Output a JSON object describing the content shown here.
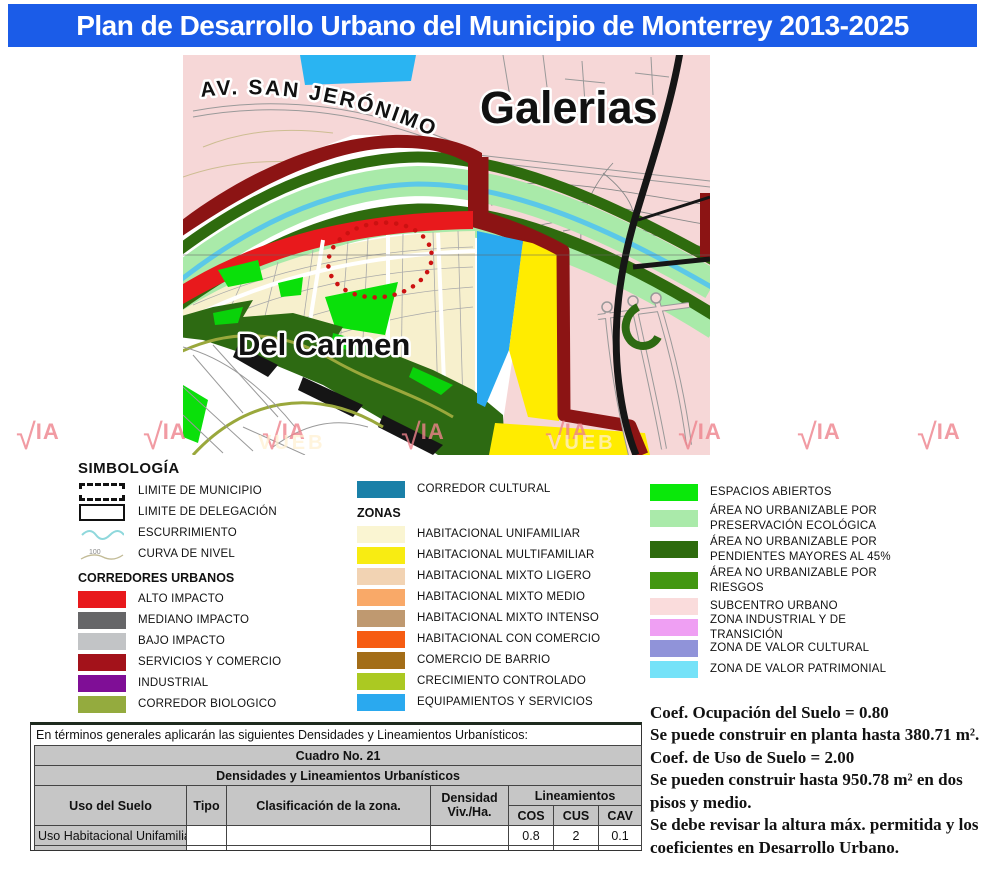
{
  "title": "Plan de Desarrollo Urbano del Municipio de Monterrey 2013-2025",
  "title_bar_color": "#1b5ce8",
  "map": {
    "labels": {
      "street": "AV. SAN JERÓNIMO",
      "district_right": "Galerias",
      "district_left": "Del Carmen"
    },
    "watermark": {
      "text": "IA",
      "fragment": "VUEB"
    }
  },
  "legend": {
    "title": "SIMBOLOGÍA",
    "symbols": [
      {
        "label": "LIMITE DE MUNICIPIO"
      },
      {
        "label": "LIMITE DE DELEGACIÓN"
      },
      {
        "label": "ESCURRIMIENTO"
      },
      {
        "label": "CURVA DE NIVEL",
        "tick": "100"
      }
    ],
    "corredores": {
      "title": "CORREDORES URBANOS",
      "items": [
        {
          "label": "ALTO IMPACTO",
          "color": "#e8191c"
        },
        {
          "label": "MEDIANO IMPACTO",
          "color": "#666668"
        },
        {
          "label": "BAJO IMPACTO",
          "color": "#c2c4c6"
        },
        {
          "label": "SERVICIOS Y COMERCIO",
          "color": "#a3121a"
        },
        {
          "label": "INDUSTRIAL",
          "color": "#7f0e96"
        },
        {
          "label": "CORREDOR BIOLOGICO",
          "color": "#94ab3e"
        }
      ]
    },
    "cultural": {
      "label": "CORREDOR CULTURAL",
      "color": "#1a80a8"
    },
    "zonas": {
      "title": "ZONAS",
      "items": [
        {
          "label": "HABITACIONAL UNIFAMILIAR",
          "color": "#faf5d2"
        },
        {
          "label": "HABITACIONAL MULTIFAMILIAR",
          "color": "#f8ec12"
        },
        {
          "label": "HABITACIONAL MIXTO LIGERO",
          "color": "#f2d3b3"
        },
        {
          "label": "HABITACIONAL MIXTO MEDIO",
          "color": "#f9a968"
        },
        {
          "label": "HABITACIONAL MIXTO INTENSO",
          "color": "#bf9970"
        },
        {
          "label": "HABITACIONAL CON COMERCIO",
          "color": "#f65c12"
        },
        {
          "label": "COMERCIO DE BARRIO",
          "color": "#a36d18"
        },
        {
          "label": "CRECIMIENTO CONTROLADO",
          "color": "#abc922"
        },
        {
          "label": "EQUIPAMIENTOS Y SERVICIOS",
          "color": "#2aa9ef"
        }
      ]
    },
    "areas": {
      "items": [
        {
          "label": "ESPACIOS ABIERTOS",
          "color": "#0ae80a"
        },
        {
          "label": "ÁREA NO URBANIZABLE POR PRESERVACIÓN ECOLÓGICA",
          "color": "#aaeaaa"
        },
        {
          "label": "ÁREA NO URBANIZABLE POR PENDIENTES MAYORES AL 45%",
          "color": "#2e6b0e"
        },
        {
          "label": "ÁREA NO URBANIZABLE POR RIESGOS",
          "color": "#429711"
        },
        {
          "label": "SUBCENTRO URBANO",
          "color": "#fadcdc"
        },
        {
          "label": "ZONA INDUSTRIAL Y DE TRANSICIÓN",
          "color": "#ef9ff3"
        },
        {
          "label": "ZONA DE VALOR CULTURAL",
          "color": "#9093d9"
        },
        {
          "label": "ZONA DE VALOR PATRIMONIAL",
          "color": "#75e2f8"
        }
      ]
    }
  },
  "table_section": {
    "intro": "En términos generales aplicarán las siguientes Densidades y Lineamientos Urbanísticos:",
    "table": {
      "title": "Cuadro No. 21",
      "subtitle": "Densidades y Lineamientos Urbanísticos",
      "headers": {
        "uso": "Uso del Suelo",
        "tipo": "Tipo",
        "clasificacion": "Clasificación de la zona.",
        "densidad_l1": "Densidad",
        "densidad_l2": "Viv./Ha.",
        "lineamientos": "Lineamientos",
        "cos": "COS",
        "cus": "CUS",
        "cav": "CAV"
      },
      "rows": [
        {
          "uso": "Uso Habitacional Unifamiliar",
          "tipo": "",
          "clasificacion": "",
          "densidad": "",
          "cos": "0.8",
          "cus": "2",
          "cav": "0.1"
        }
      ]
    }
  },
  "notes": {
    "lines": [
      "Coef. Ocupación del Suelo = 0.80",
      "Se puede construir en planta hasta 380.71 m².",
      "Coef. de Uso de Suelo = 2.00",
      "Se pueden construir hasta 950.78 m² en dos pisos y medio.",
      "Se debe revisar la altura máx. permitida y los coeficientes en Desarrollo Urbano."
    ]
  }
}
